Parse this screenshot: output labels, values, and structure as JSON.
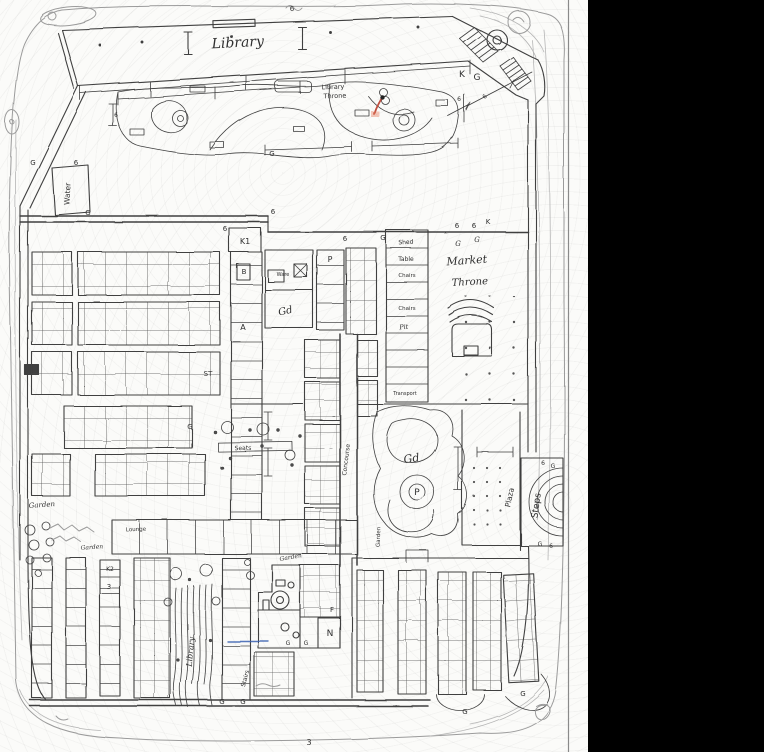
{
  "scan": {
    "paper_color": "#fbfbf9",
    "black_bar_color": "#000000",
    "edge_line_color": "#8a8a8a"
  },
  "ink": {
    "main": "#3f3f3f",
    "pencil": "#9b9b9b",
    "red_mark": "#c05040",
    "blue_mark": "#3a5fb0"
  },
  "map": {
    "labels": [
      {
        "id": "library-hall",
        "t": "Library",
        "x": 238,
        "y": 47,
        "s": 14,
        "r": -3,
        "f": "script"
      },
      {
        "id": "library-throne-1",
        "t": "Library",
        "x": 333,
        "y": 89,
        "s": 6.5,
        "r": -2
      },
      {
        "id": "library-throne-2",
        "t": "Throne",
        "x": 335,
        "y": 98,
        "s": 6.5,
        "r": -2
      },
      {
        "id": "water-room",
        "t": "Water",
        "x": 70,
        "y": 194,
        "s": 7.5,
        "r": -87
      },
      {
        "id": "room-k1",
        "t": "K1",
        "x": 245,
        "y": 244,
        "s": 8,
        "r": 0
      },
      {
        "id": "cell-b",
        "t": "B",
        "x": 244,
        "y": 274,
        "s": 7,
        "r": 0
      },
      {
        "id": "cell-a",
        "t": "A",
        "x": 243,
        "y": 330,
        "s": 8,
        "r": 0
      },
      {
        "id": "mark-st",
        "t": "ST",
        "x": 208,
        "y": 376,
        "s": 7,
        "r": 0
      },
      {
        "id": "room-ware",
        "t": "Ware",
        "x": 283,
        "y": 276,
        "s": 5,
        "r": 0
      },
      {
        "id": "gd-market",
        "t": "Gd",
        "x": 286,
        "y": 314,
        "s": 10,
        "r": -12,
        "f": "script"
      },
      {
        "id": "room-p",
        "t": "P",
        "x": 330,
        "y": 262,
        "s": 8,
        "r": 0
      },
      {
        "id": "room-shed",
        "t": "Shed",
        "x": 406,
        "y": 244,
        "s": 6,
        "r": -3
      },
      {
        "id": "room-table",
        "t": "Table",
        "x": 406,
        "y": 261,
        "s": 6,
        "r": 0
      },
      {
        "id": "room-chairs-1",
        "t": "Chairs",
        "x": 407,
        "y": 277,
        "s": 5.5,
        "r": 0
      },
      {
        "id": "room-chairs-2",
        "t": "Chairs",
        "x": 407,
        "y": 310,
        "s": 5.5,
        "r": 0
      },
      {
        "id": "room-pit",
        "t": "Pit",
        "x": 404,
        "y": 329,
        "s": 6.5,
        "r": -5,
        "f": "script"
      },
      {
        "id": "room-transport",
        "t": "Transport",
        "x": 405,
        "y": 395,
        "s": 5,
        "r": 0
      },
      {
        "id": "market-throne-1",
        "t": "Market",
        "x": 467,
        "y": 264,
        "s": 11,
        "r": -4,
        "f": "script"
      },
      {
        "id": "market-throne-2",
        "t": "Throne",
        "x": 470,
        "y": 285,
        "s": 10,
        "r": -3,
        "f": "script"
      },
      {
        "id": "gd-pond",
        "t": "Gd",
        "x": 412,
        "y": 462,
        "s": 11,
        "r": -8,
        "f": "script"
      },
      {
        "id": "p-pond",
        "t": "P",
        "x": 417,
        "y": 495,
        "s": 9,
        "r": 0
      },
      {
        "id": "plaza",
        "t": "Plaza",
        "x": 512,
        "y": 498,
        "s": 7.5,
        "r": -78
      },
      {
        "id": "steps",
        "t": "Steps",
        "x": 539,
        "y": 506,
        "s": 9,
        "r": -82
      },
      {
        "id": "garden-corridor",
        "t": "Garden",
        "x": 380,
        "y": 537,
        "s": 5.5,
        "r": -88
      },
      {
        "id": "garden-west",
        "t": "Garden",
        "x": 42,
        "y": 507,
        "s": 7,
        "r": -4,
        "f": "script"
      },
      {
        "id": "seats",
        "t": "Seats",
        "x": 243,
        "y": 450,
        "s": 6,
        "r": -2
      },
      {
        "id": "lounge",
        "t": "Lounge",
        "x": 136,
        "y": 531,
        "s": 5.5,
        "r": -2
      },
      {
        "id": "garden-sw",
        "t": "Garden",
        "x": 92,
        "y": 549,
        "s": 6,
        "r": -4,
        "f": "script"
      },
      {
        "id": "garden-mid",
        "t": "Garden",
        "x": 291,
        "y": 559,
        "s": 6,
        "r": -10,
        "f": "script"
      },
      {
        "id": "library-stacks",
        "t": "Library",
        "x": 193,
        "y": 652,
        "s": 8,
        "r": -85,
        "f": "script"
      },
      {
        "id": "stairs",
        "t": "Stairs",
        "x": 247,
        "y": 679,
        "s": 6,
        "r": -75
      },
      {
        "id": "room-n",
        "t": "N",
        "x": 330,
        "y": 636,
        "s": 9,
        "r": 0
      },
      {
        "id": "room-f",
        "t": "F",
        "x": 332,
        "y": 612,
        "s": 7,
        "r": 0
      },
      {
        "id": "room-k2",
        "t": "K2",
        "x": 110,
        "y": 571,
        "s": 6,
        "r": 0
      },
      {
        "id": "room-3",
        "t": "3",
        "x": 109,
        "y": 589,
        "s": 7,
        "r": 0
      },
      {
        "id": "concourse",
        "t": "Concourse",
        "x": 348,
        "y": 460,
        "s": 6,
        "r": -83
      },
      {
        "id": "k-corner",
        "t": "K",
        "x": 462,
        "y": 77,
        "s": 9,
        "r": 0
      },
      {
        "id": "g-corner",
        "t": "G",
        "x": 477,
        "y": 80,
        "s": 9,
        "r": 0
      },
      {
        "id": "g1",
        "t": "6",
        "x": 225,
        "y": 231,
        "s": 7,
        "r": 0
      },
      {
        "id": "g2",
        "t": "6",
        "x": 345,
        "y": 241,
        "s": 7,
        "r": 0
      },
      {
        "id": "g3",
        "t": "G",
        "x": 383,
        "y": 240,
        "s": 7,
        "r": 0
      },
      {
        "id": "g4",
        "t": "6",
        "x": 457,
        "y": 228,
        "s": 7,
        "r": 0
      },
      {
        "id": "g5",
        "t": "6",
        "x": 474,
        "y": 228,
        "s": 7,
        "r": 0
      },
      {
        "id": "g6",
        "t": "K",
        "x": 488,
        "y": 224,
        "s": 7,
        "r": 0
      },
      {
        "id": "g7",
        "t": "G",
        "x": 458,
        "y": 246,
        "s": 7,
        "r": 0,
        "f": "script"
      },
      {
        "id": "g8",
        "t": "G",
        "x": 477,
        "y": 242,
        "s": 7,
        "r": 0,
        "f": "script"
      },
      {
        "id": "g9",
        "t": "G",
        "x": 272,
        "y": 156,
        "s": 7,
        "r": 0
      },
      {
        "id": "g10",
        "t": "G",
        "x": 33,
        "y": 165,
        "s": 7,
        "r": 0
      },
      {
        "id": "g11",
        "t": "6",
        "x": 76,
        "y": 165,
        "s": 7,
        "r": 0
      },
      {
        "id": "g12",
        "t": "G",
        "x": 88,
        "y": 215,
        "s": 7,
        "r": 0
      },
      {
        "id": "g13",
        "t": "6",
        "x": 273,
        "y": 214,
        "s": 7,
        "r": 0
      },
      {
        "id": "g14",
        "t": "G",
        "x": 190,
        "y": 429,
        "s": 7,
        "r": 0
      },
      {
        "id": "g15",
        "t": "6",
        "x": 116,
        "y": 117,
        "s": 6,
        "r": 0
      },
      {
        "id": "g16",
        "t": "6",
        "x": 459,
        "y": 101,
        "s": 6,
        "r": 0
      },
      {
        "id": "g17",
        "t": "6",
        "x": 543,
        "y": 465,
        "s": 6,
        "r": 0
      },
      {
        "id": "g18",
        "t": "G",
        "x": 553,
        "y": 468,
        "s": 6,
        "r": 0
      },
      {
        "id": "g19",
        "t": "G",
        "x": 540,
        "y": 546,
        "s": 6,
        "r": 0
      },
      {
        "id": "g20",
        "t": "6",
        "x": 551,
        "y": 548,
        "s": 6,
        "r": 0
      },
      {
        "id": "g21",
        "t": "G",
        "x": 222,
        "y": 704,
        "s": 7,
        "r": 0
      },
      {
        "id": "g22",
        "t": "G",
        "x": 243,
        "y": 704,
        "s": 7,
        "r": 0
      },
      {
        "id": "g23",
        "t": "G",
        "x": 288,
        "y": 645,
        "s": 6,
        "r": 0
      },
      {
        "id": "g24",
        "t": "G",
        "x": 306,
        "y": 645,
        "s": 6,
        "r": 0
      },
      {
        "id": "g25",
        "t": "G",
        "x": 523,
        "y": 696,
        "s": 7,
        "r": 0
      },
      {
        "id": "g26",
        "t": "G",
        "x": 465,
        "y": 714,
        "s": 7,
        "r": 0
      },
      {
        "id": "num-3-bottom",
        "t": "3",
        "x": 309,
        "y": 745,
        "s": 8,
        "r": 0
      },
      {
        "id": "g27",
        "t": "6",
        "x": 292,
        "y": 11,
        "s": 7,
        "r": 0
      },
      {
        "id": "g28",
        "t": "6",
        "x": 486,
        "y": 98,
        "s": 6,
        "r": -40
      }
    ]
  }
}
